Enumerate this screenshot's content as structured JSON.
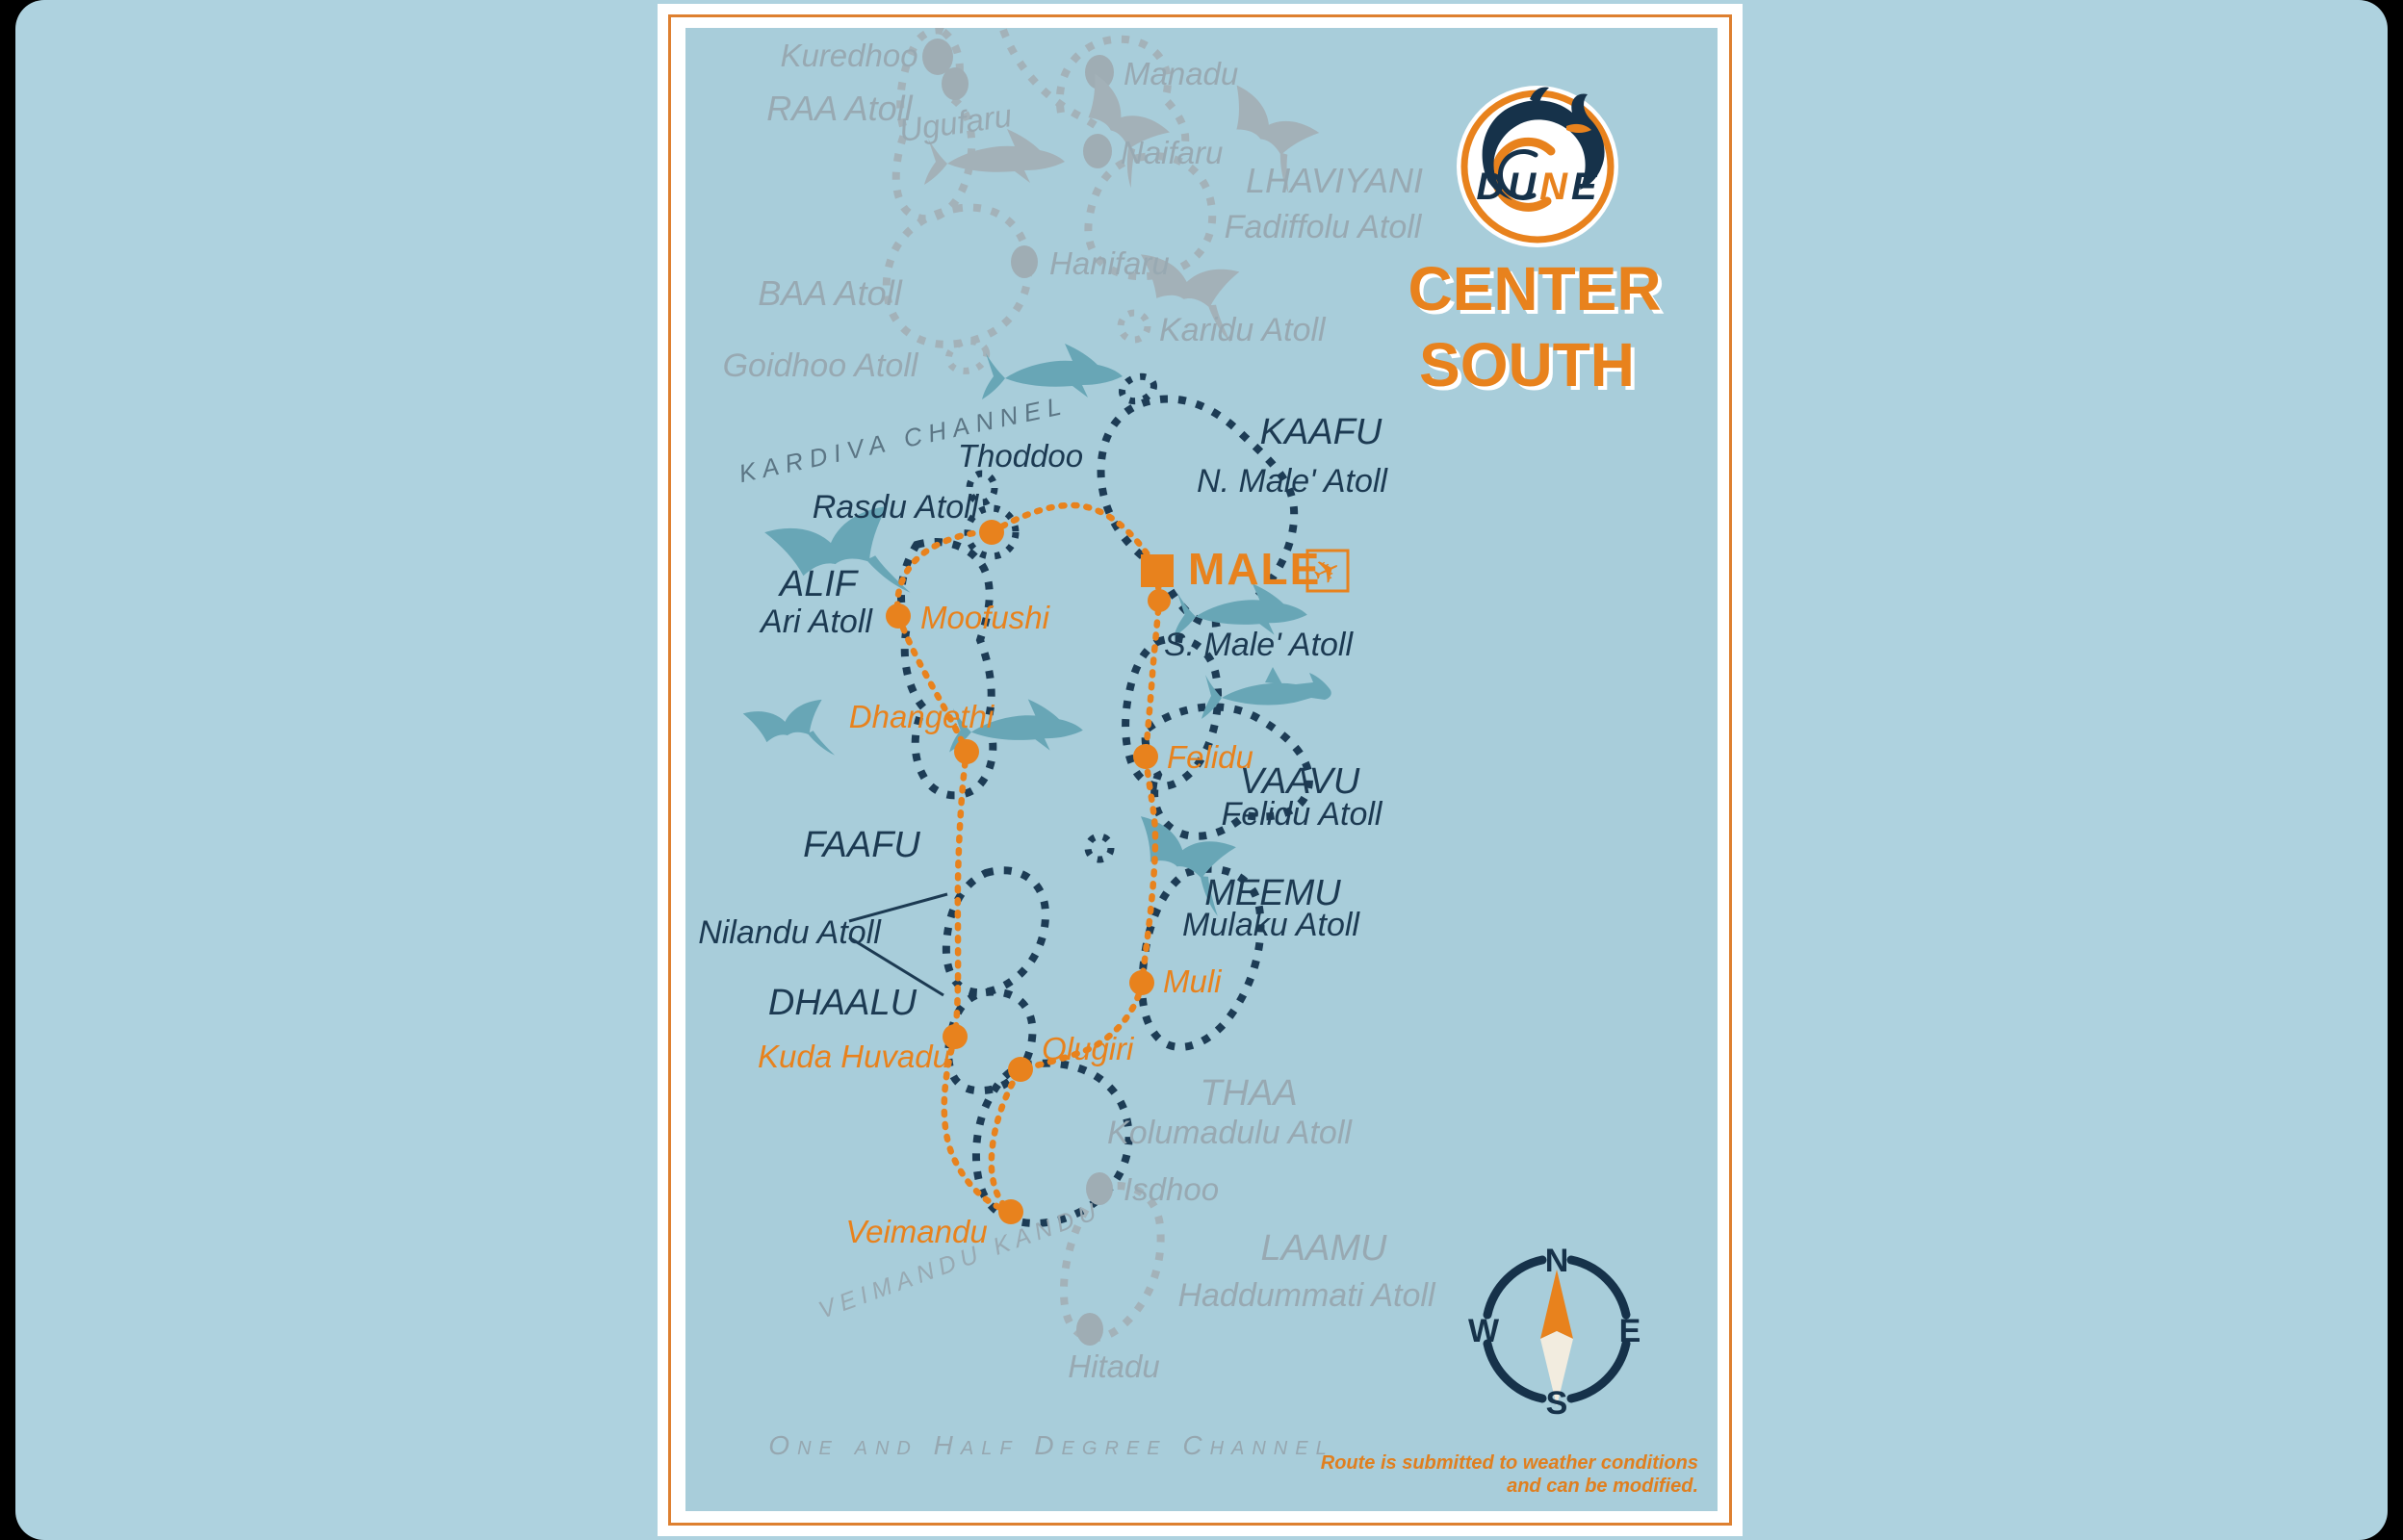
{
  "brand": {
    "name": "DUNE",
    "letters": [
      "D",
      "U",
      "N",
      "E"
    ],
    "title_line1": "CENTER",
    "title_line2": "SOUTH"
  },
  "compass": {
    "north": "N",
    "east": "E",
    "south": "S",
    "west": "W"
  },
  "disclaimer": {
    "line1": "Route is submitted to weather conditions",
    "line2": "and can be modified."
  },
  "channels": {
    "kardiva": "KARDIVA CHANNEL",
    "veimandu_kandu": "VEIMANDU KANDU",
    "one_and_half_degree": "One and Half Degree Channel"
  },
  "airport": {
    "label": "MALE",
    "icon": "✈"
  },
  "regions": {
    "raa": "RAA Atoll",
    "baa": "BAA Atoll",
    "goidhoo": "Goidhoo Atoll",
    "karidu": "Karidu Atoll",
    "lhaviyani": "LHAVIYANI",
    "fadiffolu": "Fadiffolu Atoll",
    "kaafu": "KAAFU",
    "n_male": "N. Male' Atoll",
    "s_male": "S. Male' Atoll",
    "rasdu": "Rasdu Atoll",
    "thoddoo": "Thoddoo",
    "alif": "ALIF",
    "ari": "Ari Atoll",
    "vaavu": "VAAVU",
    "felidu_atoll": "Felidu Atoll",
    "faafu": "FAAFU",
    "nilandu": "Nilandu Atoll",
    "dhaalu": "DHAALU",
    "meemu": "MEEMU",
    "mulaku": "Mulaku Atoll",
    "thaa": "THAA",
    "kolumadulu": "Kolumadulu Atoll",
    "laamu": "LAAMU",
    "haddummati": "Haddummati Atoll"
  },
  "islands": {
    "kuredhoo": "Kuredhoo",
    "ugufaru": "Ugufaru",
    "manadu": "Manadu",
    "naifaru": "Naifaru",
    "hanifaru": "Hanifaru",
    "isdhoo": "Isdhoo",
    "hitadu": "Hitadu"
  },
  "stops": {
    "moofushi": "Moofushi",
    "dhangethi": "Dhangethi",
    "felidu": "Felidu",
    "muli": "Muli",
    "olugiri": "Olugiri",
    "kuda_huvadu": "Kuda Huvadu",
    "veimandu": "Veimandu"
  },
  "colors": {
    "orange": "#e8821d",
    "navy": "#1c3a52",
    "teal": "#68a6b6",
    "gray_label": "#98a9b2",
    "gray_outline": "#a3b2b9",
    "map_bg": "#a8cdda",
    "page_bg": "#aed2df",
    "cream": "#f2ecdf"
  }
}
